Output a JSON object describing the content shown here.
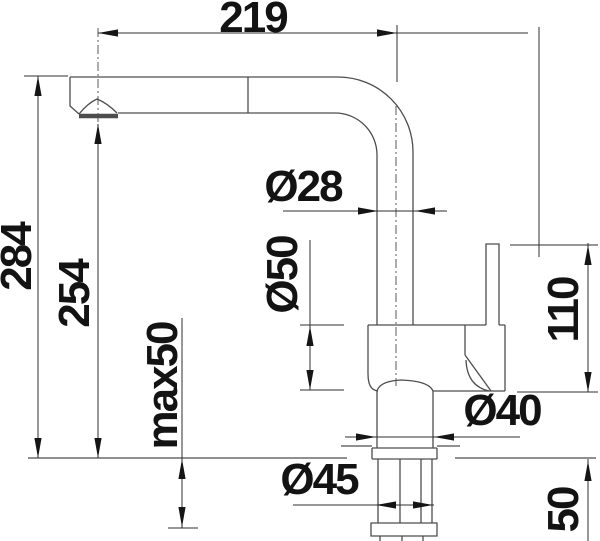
{
  "drawing": {
    "kind": "faucet technical dimension drawing",
    "unit": "mm",
    "colors": {
      "background": "#ffffff",
      "outline": "#4d4d4d",
      "dimension_lines": "#2f2f2f",
      "text": "#131313"
    },
    "labels": {
      "reach": "219",
      "overall_height": "284",
      "spout_height": "254",
      "max_deck_thickness": "max50",
      "riser_diameter": "Ø28",
      "body_diameter": "Ø50",
      "handle_height": "110",
      "base_diameter": "Ø40",
      "hole_diameter": "Ø45",
      "deck_thickness": "50"
    }
  }
}
